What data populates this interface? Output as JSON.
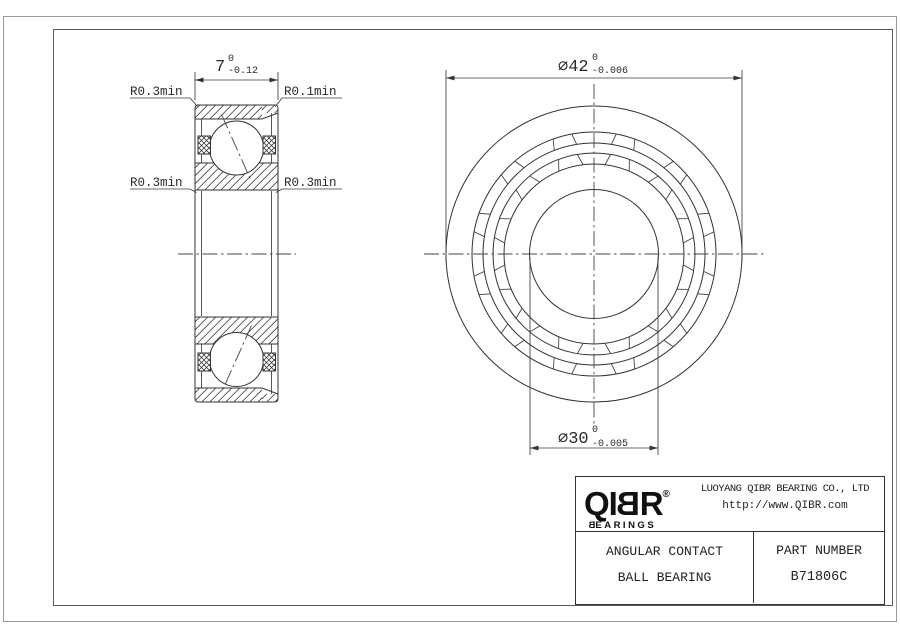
{
  "drawing": {
    "section_view": {
      "width_dim": {
        "value": "7",
        "tol_upper": "0",
        "tol_lower": "-0.12"
      },
      "labels": {
        "top_left": "R0.3min",
        "top_right": "R0.1min",
        "mid_left": "R0.3min",
        "mid_right": "R0.3min"
      }
    },
    "front_view": {
      "outer_dia": {
        "value": "⌀42",
        "tol_upper": "0",
        "tol_lower": "-0.006"
      },
      "bore_dia": {
        "value": "⌀30",
        "tol_upper": "0",
        "tol_lower": "-0.005"
      }
    }
  },
  "title_block": {
    "logo": {
      "left": "QI",
      "flipped_b": "B",
      "right": "R",
      "registered": "®",
      "sub_flipped_b": "B",
      "sub_rest": "EARINGS"
    },
    "company": "LUOYANG QIBR BEARING CO., LTD",
    "website": "http://www.QIBR.com",
    "product_line1": "ANGULAR CONTACT",
    "product_line2": "BALL BEARING",
    "part_number_label": "PART NUMBER",
    "part_number": "B71806C"
  },
  "colors": {
    "line": "#333333",
    "page_border": "#9a9a9a",
    "text": "#222222"
  }
}
